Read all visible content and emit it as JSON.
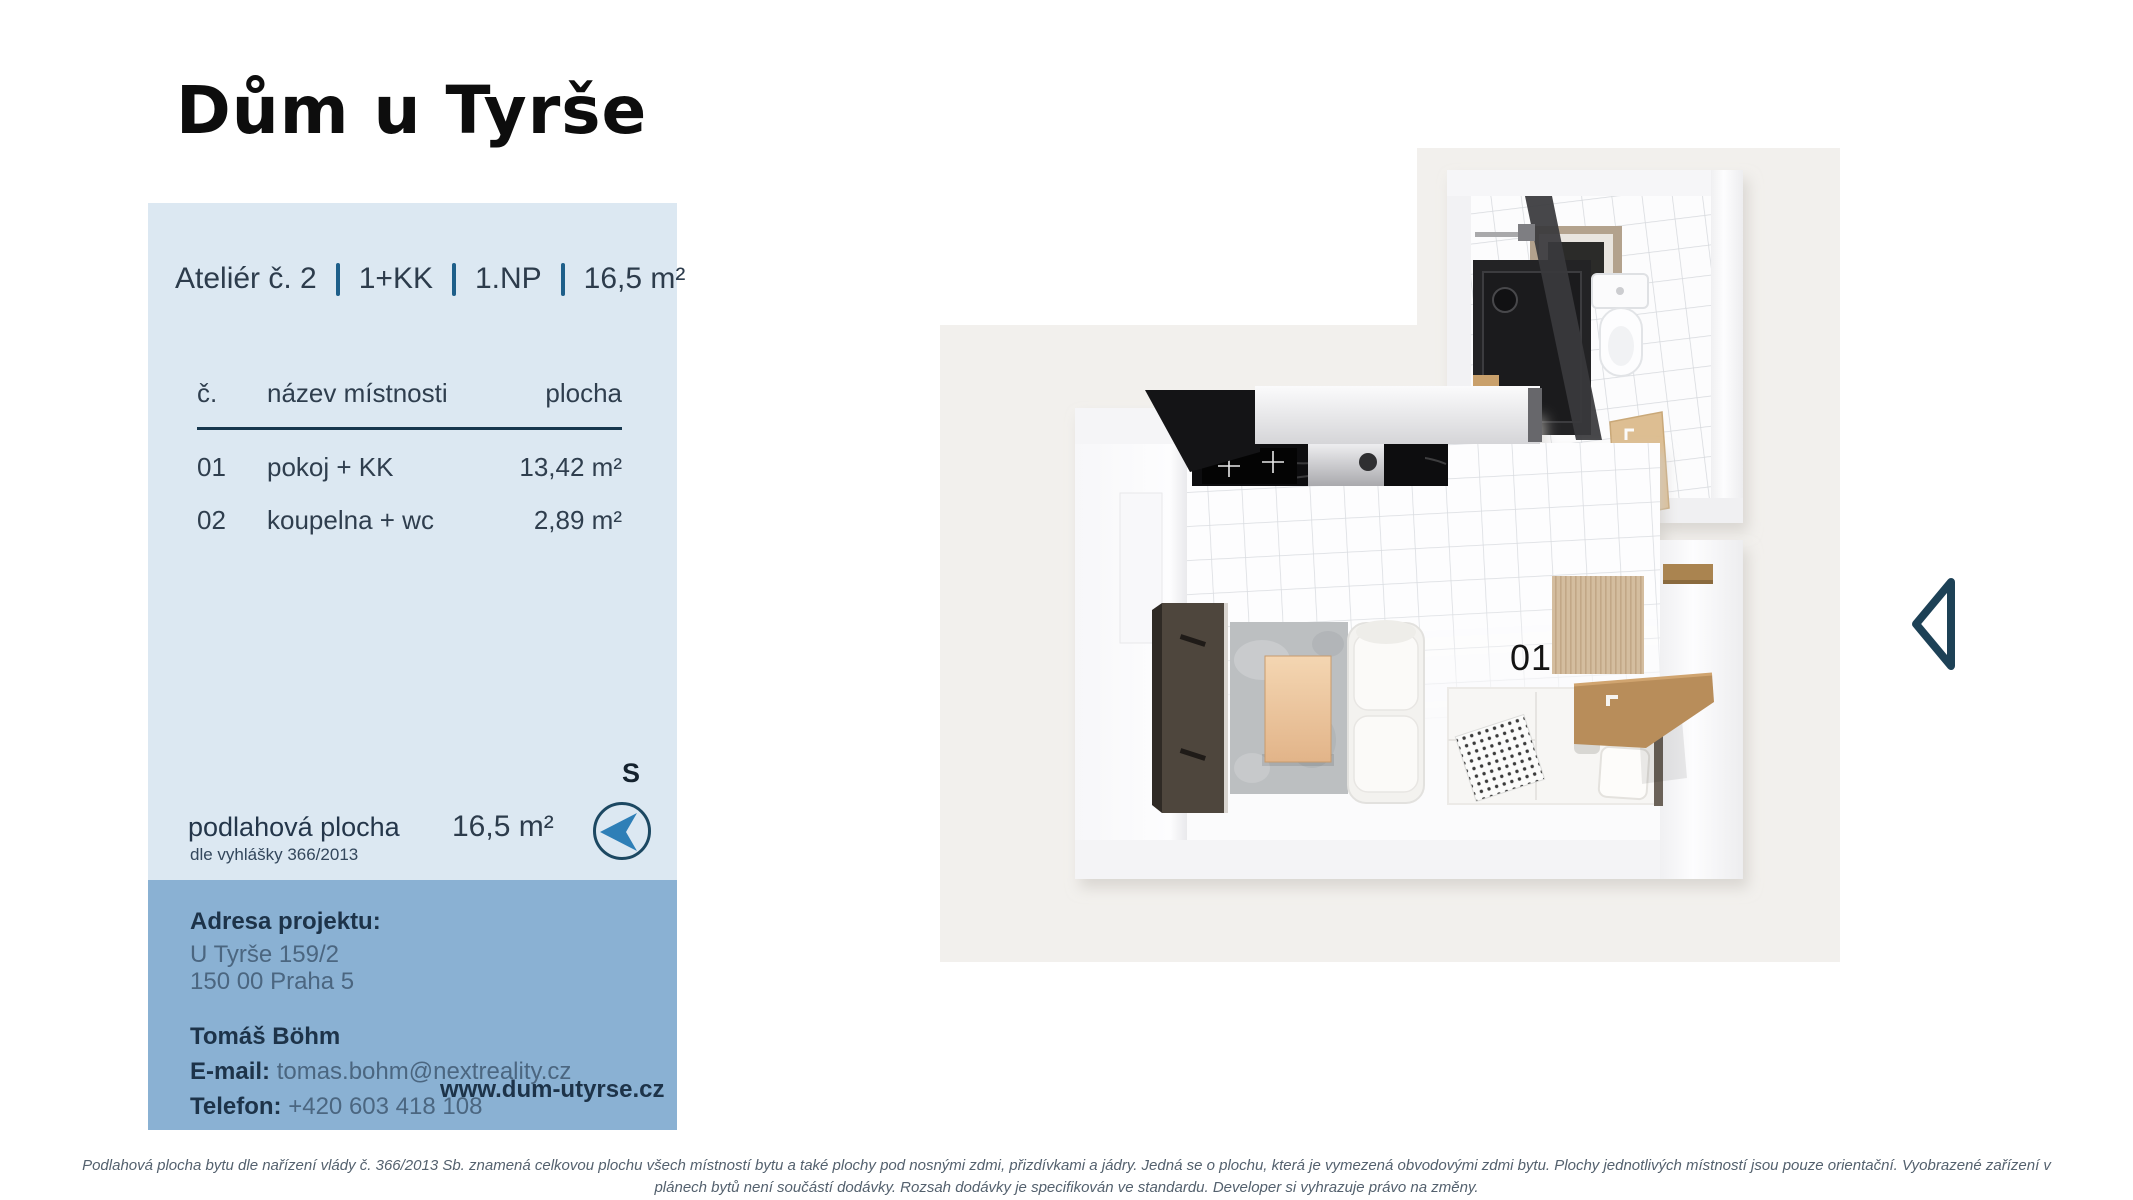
{
  "page": {
    "title": "Dům u Tyrše"
  },
  "unit": {
    "name": "Ateliér č. 2",
    "layout": "1+KK",
    "floor": "1.NP",
    "area": "16,5 m²"
  },
  "rooms": {
    "headers": {
      "number": "č.",
      "name": "název místnosti",
      "area": "plocha"
    },
    "items": [
      {
        "number": "01",
        "name": "pokoj + KK",
        "area": "13,42 m²"
      },
      {
        "number": "02",
        "name": "koupelna + wc",
        "area": "2,89 m²"
      }
    ]
  },
  "floor_area": {
    "label": "podlahová plocha",
    "note": "dle vyhlášky 366/2013",
    "value": "16,5 m²"
  },
  "compass": {
    "direction_label": "S"
  },
  "contact": {
    "address_label": "Adresa projektu:",
    "address_line1": "U Tyrše 159/2",
    "address_line2": "150 00 Praha 5",
    "person": "Tomáš Böhm",
    "email_label": "E-mail:",
    "email": "tomas.bohm@nextreality.cz",
    "phone_label": "Telefon:",
    "phone": "+420 603 418 108",
    "website": "www.dum-utyrse.cz"
  },
  "floorplan": {
    "room1_label": "01",
    "room2_label": "02"
  },
  "icons": {
    "nav_previous": "chevron-left-outline",
    "compass": "north-needle"
  },
  "disclaimer": {
    "line1": "Podlahová plocha bytu dle nařízení vlády č. 366/2013 Sb. znamená celkovou plochu všech místností bytu a také plochy pod nosnými zdmi, přizdívkami a jádry. Jedná se o plochu, která je vymezená obvodovými zdmi bytu. Plochy jednotlivých místností jsou pouze orientační. Vyobrazené zařízení v",
    "line2": "plánech bytů není součástí dodávky. Rozsah dodávky je specifikován ve standardu. Developer si vyhrazuje právo na změny."
  },
  "colors": {
    "panel_light": "#dce8f2",
    "panel_dark": "#8ab1d3",
    "accent_navy": "#1d4156",
    "separator_blue": "#1e5f8a",
    "compass_needle": "#2e7fb7",
    "backdrop_gray": "#f2f0ed"
  }
}
